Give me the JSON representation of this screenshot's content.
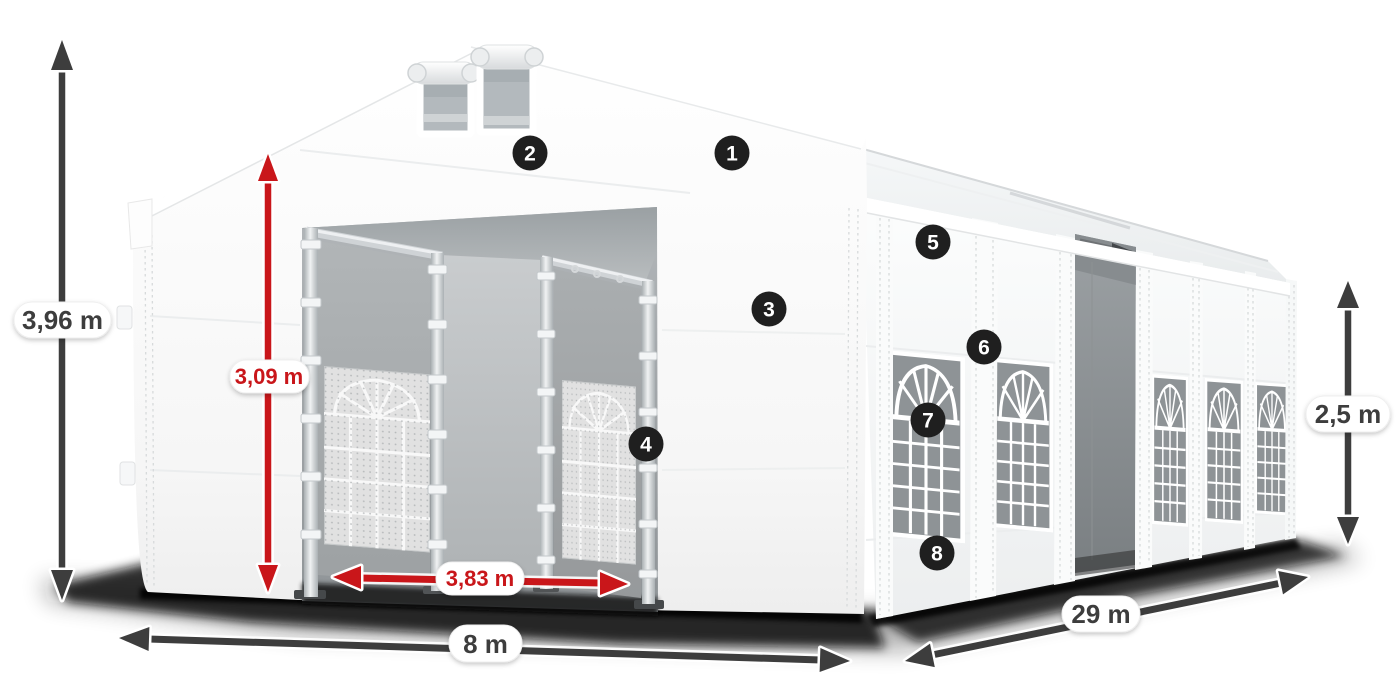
{
  "title": "Storage tent dimensions diagram",
  "dims": {
    "total_height": {
      "label": "3,96 m",
      "color": "#3d3d3d"
    },
    "door_height": {
      "label": "3,09 m",
      "color": "#c9161a"
    },
    "door_width": {
      "label": "3,83 m",
      "color": "#c9161a"
    },
    "front_width": {
      "label": "8 m",
      "color": "#3d3d3d"
    },
    "side_length": {
      "label": "29 m",
      "color": "#3d3d3d"
    },
    "side_height": {
      "label": "2,5 m",
      "color": "#3d3d3d"
    }
  },
  "callouts": [
    {
      "number": "1"
    },
    {
      "number": "2"
    },
    {
      "number": "3"
    },
    {
      "number": "4"
    },
    {
      "number": "5"
    },
    {
      "number": "6"
    },
    {
      "number": "7"
    },
    {
      "number": "8"
    }
  ],
  "colors": {
    "accent_red": "#c9161a",
    "dimension_gray": "#3d3d3d",
    "callout_bg": "#1f1f1f",
    "tent_white": "#ffffff"
  }
}
